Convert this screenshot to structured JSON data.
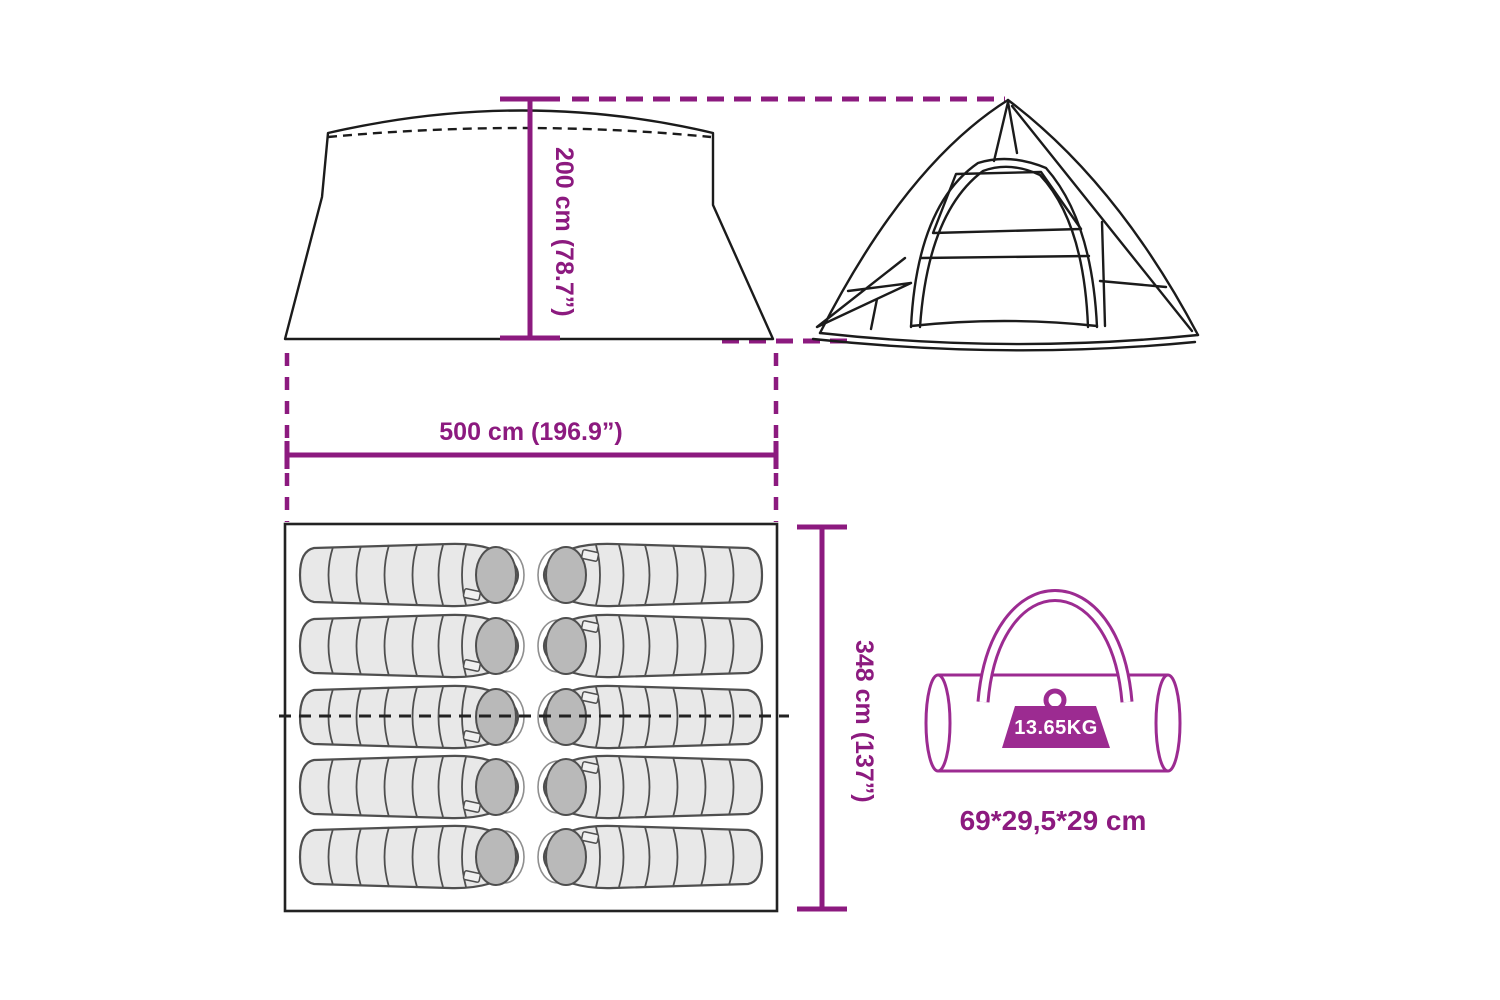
{
  "diagram": {
    "labels": {
      "tent_height": "200 cm (78.7”)",
      "tent_width": "500 cm (196.9”)",
      "floor_depth": "348 cm (137”)",
      "pack_weight": "13.65KG",
      "pack_size": "69*29,5*29 cm"
    },
    "sleeping_bag_count": 10,
    "icons": {
      "front_view": "tent-front-view-drawing",
      "side_view": "tent-side-view-drawing",
      "floor_plan": "tent-floor-plan-drawing",
      "carry_bag": "carry-bag-drawing",
      "weight": "weight-icon"
    },
    "colors": {
      "accent": "#8c1a7f",
      "bag_accent": "#9c2b91",
      "line": "#1b1b1b",
      "sleeping_bag_fill": "#e8e8e8",
      "sleeping_bag_hood": "#b9b9b9",
      "sleeping_bag_stroke": "#4f4f4f"
    }
  }
}
